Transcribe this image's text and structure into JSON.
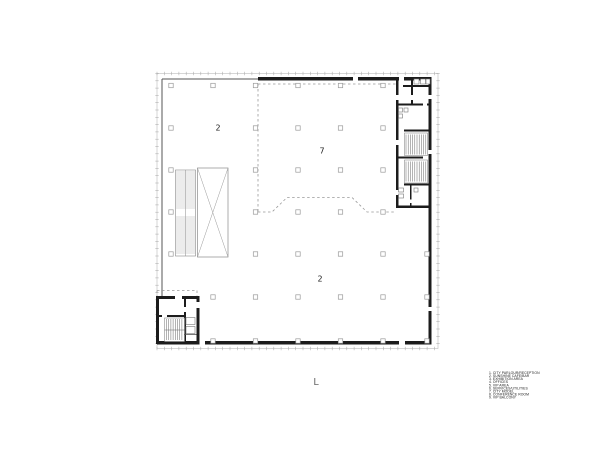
{
  "plan": {
    "area_labels": [
      {
        "id": "area-2-upper",
        "text": "2",
        "x": 218,
        "y": 128
      },
      {
        "id": "area-7-center",
        "text": "7",
        "x": 322,
        "y": 151
      },
      {
        "id": "area-2-lower",
        "text": "2",
        "x": 320,
        "y": 279
      }
    ],
    "level_label": "L"
  },
  "legend": {
    "items": [
      "1. CITY PARLOUR/RECEPTION",
      "2. SUNSHINE CAFE/BAR",
      "3. EXHIBITION AREA",
      "4. OFFICES",
      "5. VIP AREA",
      "6. SERVICES/UTILITIES",
      "7. CITY MODEL",
      "8. CONFERENCE ROOM",
      "9. VIP BALCONY"
    ]
  },
  "colors": {
    "background": "#ffffff",
    "ink": "#1c1c1c",
    "thin_wall": "#555555",
    "facade_line": "#bbbbbb",
    "tick_line": "#aaaaaa",
    "dashed_line": "#999999",
    "column_line": "#999999",
    "hatch_line": "#777777",
    "area_label": "#222222",
    "level_label": "#666666",
    "legend_text": "#1a1a1a"
  }
}
